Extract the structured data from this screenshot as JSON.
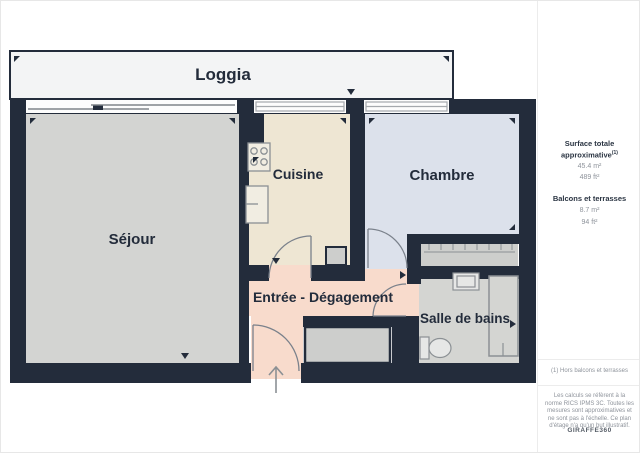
{
  "plan": {
    "rooms": {
      "loggia": {
        "label": "Loggia"
      },
      "sejour": {
        "label": "Séjour"
      },
      "cuisine": {
        "label": "Cuisine"
      },
      "chambre": {
        "label": "Chambre"
      },
      "entree": {
        "label": "Entrée - Dégagement"
      },
      "bain": {
        "label": "Salle de bains"
      }
    },
    "colors": {
      "wall": "#232c3b",
      "loggia_floor": "#f3f4f5",
      "sejour_floor": "#d3d4d2",
      "cuisine_floor": "#eee6d3",
      "chambre_floor": "#dce1eb",
      "entree_floor": "#f8dbcc",
      "bain_floor": "#d4d5d2",
      "closet_floor": "#cdcecc",
      "fixture_stroke": "#8b9094",
      "label_text": "#232c3b"
    }
  },
  "sidebar": {
    "surface_title": "Surface totale approximative",
    "surface_note_ref": "(1)",
    "surface_m2": "45.4 m²",
    "surface_ft2": "489 ft²",
    "balconies_title": "Balcons et terrasses",
    "balconies_m2": "8.7 m²",
    "balconies_ft2": "94 ft²",
    "footnote": "(1) Hors balcons et terrasses",
    "disclaimer": "Les calculs se réfèrent à la norme RICS IPMS 3C. Toutes les mesures sont approximatives et ne sont pas à l'échelle. Ce plan d'étage n'a qu'un but illustratif.",
    "brand": "GIRAFFE360"
  }
}
